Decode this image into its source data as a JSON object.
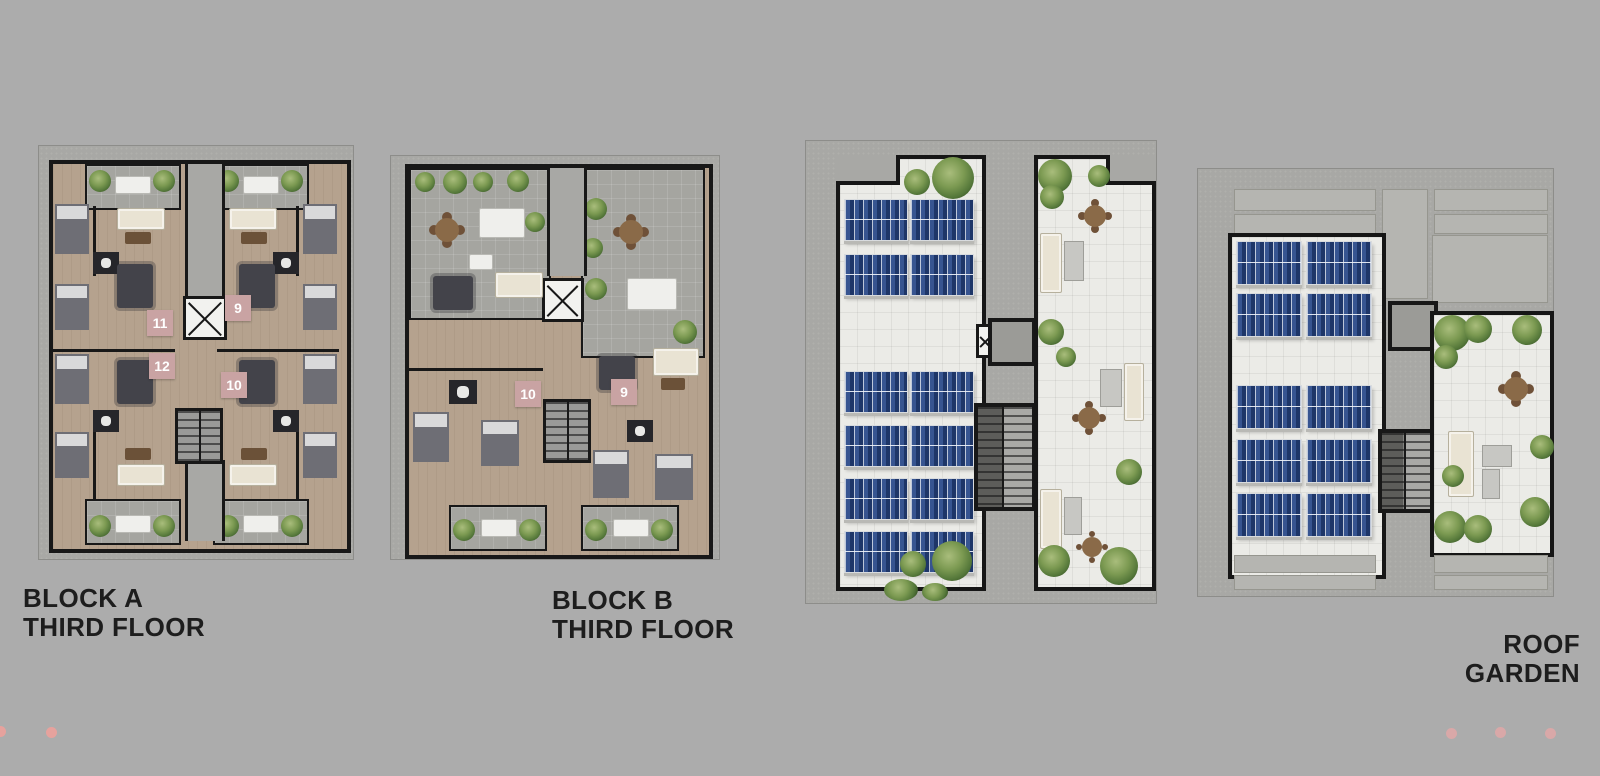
{
  "canvas": {
    "width": 1600,
    "height": 776,
    "background_color": "#acacac"
  },
  "plans": {
    "block_a": {
      "title_line1": "BLOCK A",
      "title_line2": "THIRD FLOOR",
      "unit_badges": [
        {
          "number": "11"
        },
        {
          "number": "12"
        },
        {
          "number": "9"
        },
        {
          "number": "10"
        }
      ]
    },
    "block_b": {
      "title_line1": "BLOCK B",
      "title_line2": "THIRD FLOOR",
      "unit_badges": [
        {
          "number": "10"
        },
        {
          "number": "9"
        }
      ]
    },
    "roof_garden": {
      "title_line1": "ROOF",
      "title_line2": "GARDEN"
    }
  },
  "colors": {
    "background": "#acacac",
    "pavement": "#a8a8a5",
    "wall": "#181818",
    "wood_floor": "#b5a28e",
    "terrace_stone": "#a5a5a0",
    "roof_tile": "#ebebe7",
    "solar_panel_blue": "#1d3362",
    "plant_green": "#7c9a52",
    "unit_badge": "#c9a3a3",
    "label_text": "#1d1d1d",
    "carousel_dot": "#e6a29d"
  },
  "carousel": {
    "left_dots": 2,
    "right_dots": 3
  }
}
